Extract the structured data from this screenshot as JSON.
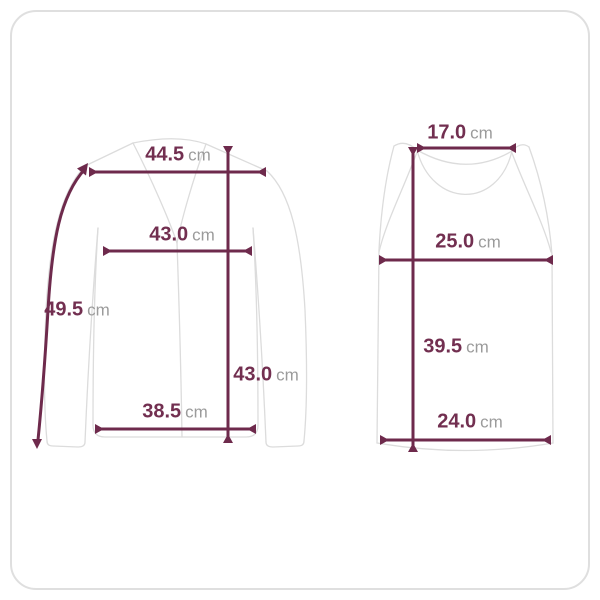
{
  "diagram_title": "garment-size-measurement-diagram",
  "colors": {
    "dimension_line": "#6e2a4c",
    "value_text": "#722f50",
    "unit_text": "#9b9b9b",
    "garment_outline": "#dcdcdc",
    "card_border": "#dfdfdf",
    "background": "#ffffff"
  },
  "garments": [
    {
      "name": "long-sleeve-cardigan",
      "measurements": [
        {
          "dimension": "shoulder-width",
          "value": "44.5",
          "unit": "cm"
        },
        {
          "dimension": "chest-width",
          "value": "43.0",
          "unit": "cm"
        },
        {
          "dimension": "sleeve-length",
          "value": "49.5",
          "unit": "cm"
        },
        {
          "dimension": "total-length",
          "value": "43.0",
          "unit": "cm"
        },
        {
          "dimension": "hem-width",
          "value": "38.5",
          "unit": "cm"
        }
      ]
    },
    {
      "name": "tank-top",
      "measurements": [
        {
          "dimension": "shoulder-width",
          "value": "17.0",
          "unit": "cm"
        },
        {
          "dimension": "chest-width",
          "value": "25.0",
          "unit": "cm"
        },
        {
          "dimension": "total-length",
          "value": "39.5",
          "unit": "cm"
        },
        {
          "dimension": "hem-width",
          "value": "24.0",
          "unit": "cm"
        }
      ]
    }
  ]
}
